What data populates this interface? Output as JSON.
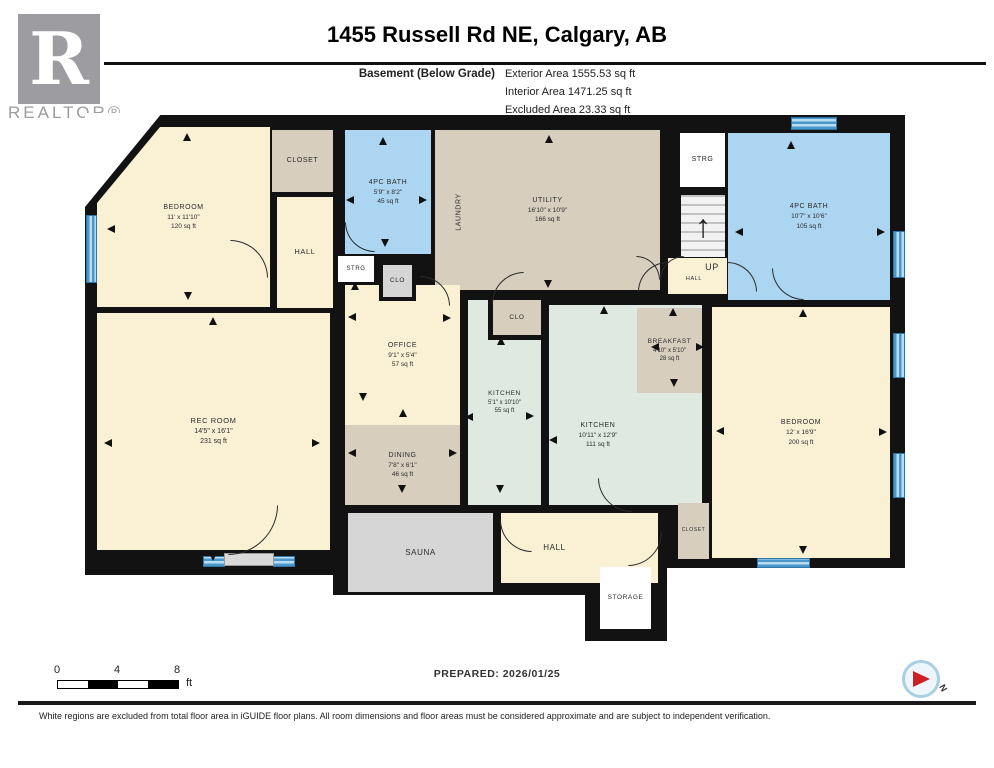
{
  "header": {
    "title": "1455 Russell Rd NE, Calgary, AB",
    "floor_label": "Basement (Below Grade)",
    "areas": [
      "Exterior Area 1555.53 sq ft",
      "Interior Area 1471.25 sq ft",
      "Excluded Area 23.33 sq ft"
    ]
  },
  "branding": {
    "logo_letter": "R",
    "realtor_text": "REALTOR®"
  },
  "footer": {
    "prepared": "PREPARED: 2026/01/25",
    "disclaimer": "White regions are excluded from total floor area in iGUIDE floor plans. All room dimensions and floor areas must be considered approximate and are subject to independent verification.",
    "scale": {
      "ticks": [
        "0",
        "4",
        "8"
      ],
      "unit": "ft"
    },
    "compass_label": "N"
  },
  "colors": {
    "wall": "#121212",
    "cream": "#FAF1D5",
    "taupe": "#D8CEBE",
    "blue": "#ACD5F1",
    "mint": "#DFE9E2",
    "gray": "#D6D6D6",
    "white": "#FFFFFF",
    "window": "#4A97CC",
    "window_light": "#B9DCF0",
    "accent_red": "#CE2127"
  },
  "plan": {
    "walls": [
      [
        85,
        115,
        820,
        453
      ],
      [
        85,
        550,
        258,
        25
      ],
      [
        333,
        505,
        333,
        90
      ],
      [
        585,
        555,
        82,
        86
      ],
      [
        845,
        205,
        45,
        11
      ],
      [
        843,
        270,
        47,
        31
      ]
    ],
    "cutouts": [
      {
        "r": [
          85,
          113,
          77,
          94
        ],
        "clip": "polygon(0 0, 100% 0, 0 100%)"
      }
    ],
    "rooms": [
      {
        "id": "utility",
        "lines": [
          "UTILITY",
          "16'10\" x 10'9\"",
          "166 sq ft"
        ],
        "r": [
          435,
          130,
          225,
          160
        ],
        "c": "taupe",
        "fs": 7
      },
      {
        "id": "bedroom-top-left",
        "lines": [
          "BEDROOM",
          "11' x 11'10\"",
          "120 sq ft"
        ],
        "r": [
          97,
          127,
          173,
          180
        ],
        "c": "cream",
        "fs": 7,
        "clip": "polygon(63px 0, 100% 0, 100% 100%, 0 100%, 0 76px)"
      },
      {
        "id": "closet-top-left",
        "lines": [
          "CLOSET"
        ],
        "r": [
          272,
          130,
          61,
          62
        ],
        "c": "taupe",
        "fs": 7
      },
      {
        "id": "hall-upper",
        "lines": [
          "HALL"
        ],
        "r": [
          277,
          197,
          56,
          111
        ],
        "c": "cream",
        "fs": 7.5
      },
      {
        "id": "bath-left",
        "lines": [
          "4PC BATH",
          "5'9\" x 8'2\"",
          "45 sq ft"
        ],
        "r": [
          345,
          130,
          86,
          124
        ],
        "c": "blue",
        "fs": 7
      },
      {
        "id": "strg-top",
        "lines": [
          "STRG"
        ],
        "r": [
          680,
          133,
          45,
          54
        ],
        "c": "white",
        "fs": 7
      },
      {
        "id": "up-hall",
        "lines": [],
        "r": [
          668,
          258,
          59,
          36
        ],
        "c": "cream",
        "fs": 7
      },
      {
        "id": "bath-right",
        "lines": [
          "4PC BATH",
          "10'7\" x 10'6\"",
          "105 sq ft"
        ],
        "r": [
          728,
          133,
          162,
          167
        ],
        "c": "blue",
        "fs": 7
      },
      {
        "id": "rec-room",
        "lines": [
          "REC ROOM",
          "14'5\" x 16'1\"",
          "231 sq ft"
        ],
        "r": [
          97,
          313,
          233,
          237
        ],
        "c": "cream",
        "fs": 7.5
      },
      {
        "id": "office",
        "lines": [
          "OFFICE",
          "9'1\" x 5'4\"",
          "57 sq ft"
        ],
        "r": [
          345,
          285,
          115,
          140
        ],
        "c": "cream",
        "fs": 7
      },
      {
        "id": "dining",
        "lines": [
          "DINING",
          "7'8\" x 6'1\"",
          "46 sq ft"
        ],
        "r": [
          345,
          425,
          115,
          80
        ],
        "c": "taupe",
        "fs": 7
      },
      {
        "id": "kitchen-small",
        "lines": [
          "KITCHEN",
          "5'1\" x 10'10\"",
          "55 sq ft"
        ],
        "r": [
          468,
          300,
          73,
          205
        ],
        "c": "mint",
        "fs": 6.5
      },
      {
        "id": "kitchen-main",
        "lines": [
          "KITCHEN",
          "10'11\" x 12'9\"",
          "111 sq ft"
        ],
        "r": [
          549,
          305,
          153,
          200
        ],
        "c": "mint",
        "fs": 7,
        "pad": "60px 55px 0 0"
      },
      {
        "id": "breakfast",
        "lines": [
          "BREAKFAST",
          "4'10\" x 5'10\"",
          "28 sq ft"
        ],
        "r": [
          637,
          308,
          65,
          85
        ],
        "c": "taupe",
        "fs": 6.5
      },
      {
        "id": "bedroom-right",
        "lines": [
          "BEDROOM",
          "12' x 16'9\"",
          "200 sq ft"
        ],
        "r": [
          712,
          307,
          178,
          251
        ],
        "c": "cream",
        "fs": 7
      },
      {
        "id": "sauna",
        "lines": [
          "SAUNA"
        ],
        "r": [
          348,
          513,
          145,
          79
        ],
        "c": "gray",
        "fs": 8
      },
      {
        "id": "hall-lower",
        "lines": [
          "HALL"
        ],
        "r": [
          501,
          513,
          157,
          70
        ],
        "c": "cream",
        "fs": 8,
        "pad": "0 50px 0 0"
      },
      {
        "id": "storage",
        "lines": [
          "STORAGE"
        ],
        "r": [
          600,
          567,
          51,
          62
        ],
        "c": "white",
        "fs": 6.5
      },
      {
        "id": "closet-right",
        "lines": [
          "CLOSET"
        ],
        "r": [
          678,
          503,
          31,
          56
        ],
        "c": "taupe",
        "fs": 5
      },
      {
        "id": "strg-small",
        "lines": [
          "STRG"
        ],
        "r": [
          338,
          256,
          36,
          26
        ],
        "c": "white",
        "fs": 6
      },
      {
        "id": "clo-small",
        "lines": [
          "CLO"
        ],
        "r": [
          379,
          261,
          37,
          40
        ],
        "c": "gray",
        "fs": 6.5,
        "bd": "border:4px solid #121212;"
      },
      {
        "id": "clo-kitchen",
        "lines": [
          "CLO"
        ],
        "r": [
          488,
          300,
          53,
          40
        ],
        "c": "taupe",
        "fs": 6.5,
        "bd": "border-left:5px solid #121212;border-bottom:5px solid #121212;"
      }
    ],
    "stairs": {
      "r": [
        681,
        195,
        44,
        62
      ]
    },
    "labels": [
      {
        "id": "laundry",
        "t": "LAUNDRY",
        "x": 459,
        "y": 212,
        "rot": -90,
        "fs": 7
      },
      {
        "id": "up",
        "t": "UP",
        "x": 712,
        "y": 267,
        "rot": 0,
        "fs": 9
      },
      {
        "id": "up-hall-tag",
        "t": "HALL",
        "x": 694,
        "y": 279,
        "rot": 0,
        "fs": 5.5
      }
    ],
    "windows": [
      {
        "r": [
          86,
          215,
          11,
          68
        ]
      },
      {
        "r": [
          791,
          117,
          46,
          13
        ]
      },
      {
        "r": [
          893,
          231,
          12,
          47
        ]
      },
      {
        "r": [
          893,
          333,
          12,
          45
        ]
      },
      {
        "r": [
          893,
          453,
          12,
          45
        ]
      },
      {
        "r": [
          757,
          558,
          53,
          10
        ]
      },
      {
        "r": [
          203,
          556,
          22,
          11
        ]
      },
      {
        "r": [
          273,
          556,
          22,
          11
        ]
      }
    ],
    "panels": [
      {
        "r": [
          224,
          553,
          50,
          13
        ]
      }
    ],
    "arcs": [
      {
        "x": 230,
        "y": 240,
        "s": 38,
        "q": "tr"
      },
      {
        "x": 345,
        "y": 222,
        "s": 30,
        "q": "bl"
      },
      {
        "x": 636,
        "y": 256,
        "s": 24,
        "q": "tr"
      },
      {
        "x": 660,
        "y": 256,
        "s": 24,
        "q": "tl"
      },
      {
        "x": 420,
        "y": 276,
        "s": 30,
        "q": "tr"
      },
      {
        "x": 492,
        "y": 272,
        "s": 32,
        "q": "tl"
      },
      {
        "x": 638,
        "y": 262,
        "s": 30,
        "q": "tl"
      },
      {
        "x": 727,
        "y": 262,
        "s": 30,
        "q": "tr"
      },
      {
        "x": 772,
        "y": 268,
        "s": 32,
        "q": "bl"
      },
      {
        "x": 598,
        "y": 478,
        "s": 34,
        "q": "bl"
      },
      {
        "x": 228,
        "y": 505,
        "s": 50,
        "q": "br"
      },
      {
        "x": 500,
        "y": 520,
        "s": 32,
        "q": "bl"
      },
      {
        "x": 628,
        "y": 532,
        "s": 34,
        "q": "br"
      }
    ],
    "arrows": [
      {
        "x": 187,
        "y": 137,
        "d": "up"
      },
      {
        "x": 383,
        "y": 141,
        "d": "up"
      },
      {
        "x": 549,
        "y": 139,
        "d": "up"
      },
      {
        "x": 791,
        "y": 145,
        "d": "up"
      },
      {
        "x": 673,
        "y": 312,
        "d": "up"
      },
      {
        "x": 803,
        "y": 313,
        "d": "up"
      },
      {
        "x": 213,
        "y": 321,
        "d": "up"
      },
      {
        "x": 403,
        "y": 413,
        "d": "up"
      },
      {
        "x": 501,
        "y": 341,
        "d": "up"
      },
      {
        "x": 604,
        "y": 310,
        "d": "up"
      },
      {
        "x": 355,
        "y": 286,
        "d": "up"
      },
      {
        "x": 188,
        "y": 296,
        "d": "down"
      },
      {
        "x": 385,
        "y": 243,
        "d": "down"
      },
      {
        "x": 548,
        "y": 284,
        "d": "down"
      },
      {
        "x": 213,
        "y": 557,
        "d": "down"
      },
      {
        "x": 402,
        "y": 489,
        "d": "down"
      },
      {
        "x": 500,
        "y": 489,
        "d": "down"
      },
      {
        "x": 674,
        "y": 383,
        "d": "down"
      },
      {
        "x": 803,
        "y": 550,
        "d": "down"
      },
      {
        "x": 363,
        "y": 397,
        "d": "down"
      },
      {
        "x": 111,
        "y": 229,
        "d": "left"
      },
      {
        "x": 350,
        "y": 200,
        "d": "left"
      },
      {
        "x": 739,
        "y": 232,
        "d": "left"
      },
      {
        "x": 352,
        "y": 317,
        "d": "left"
      },
      {
        "x": 469,
        "y": 417,
        "d": "left"
      },
      {
        "x": 553,
        "y": 440,
        "d": "left"
      },
      {
        "x": 352,
        "y": 453,
        "d": "left"
      },
      {
        "x": 655,
        "y": 347,
        "d": "left"
      },
      {
        "x": 720,
        "y": 431,
        "d": "left"
      },
      {
        "x": 108,
        "y": 443,
        "d": "left"
      },
      {
        "x": 423,
        "y": 200,
        "d": "right"
      },
      {
        "x": 881,
        "y": 232,
        "d": "right"
      },
      {
        "x": 447,
        "y": 318,
        "d": "right"
      },
      {
        "x": 530,
        "y": 416,
        "d": "right"
      },
      {
        "x": 453,
        "y": 453,
        "d": "right"
      },
      {
        "x": 700,
        "y": 347,
        "d": "right"
      },
      {
        "x": 883,
        "y": 432,
        "d": "right"
      },
      {
        "x": 316,
        "y": 443,
        "d": "right"
      },
      {
        "x": 421,
        "y": 273,
        "d": "right"
      }
    ]
  }
}
